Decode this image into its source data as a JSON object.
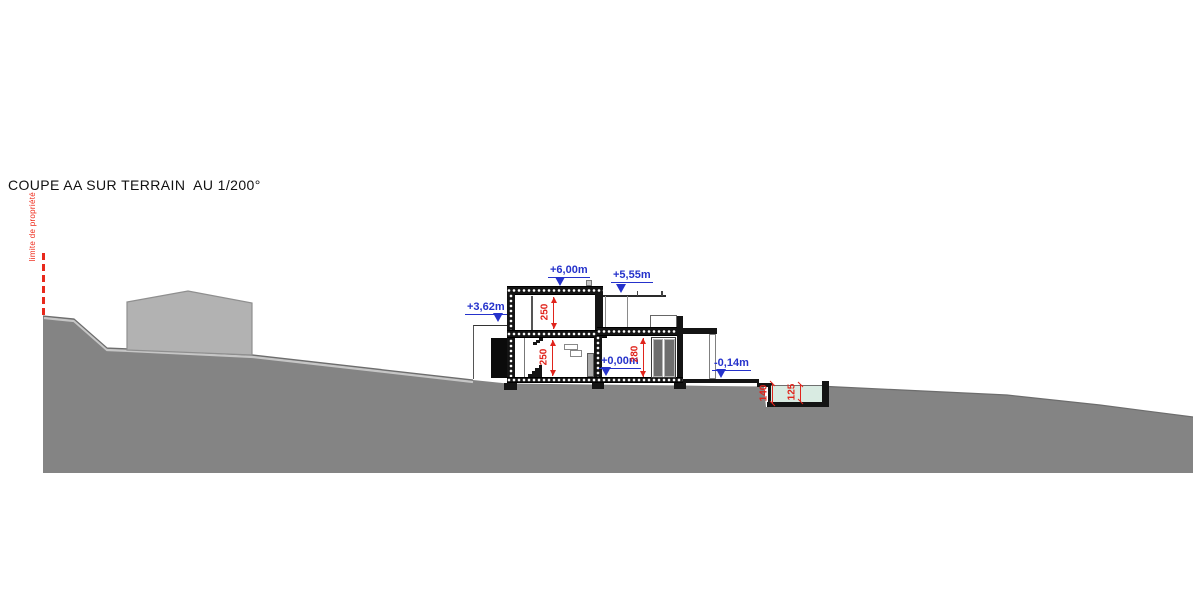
{
  "title": "COUPE AA SUR TERRAIN  AU 1/200°",
  "property_line_label": "limite de propriété",
  "levels": [
    {
      "label": "+6,00m",
      "location": "main flat roof top"
    },
    {
      "label": "+5,55m",
      "location": "canopy over east terrace"
    },
    {
      "label": "+3,62m",
      "location": "entrance porch wall top"
    },
    {
      "label": "+0,00m",
      "location": "ground floor finished level"
    },
    {
      "label": "-0,14m",
      "location": "outdoor terrace level"
    }
  ],
  "dimensions_cm": [
    {
      "label": "250",
      "location": "upper floor clear height"
    },
    {
      "label": "250",
      "location": "ground floor clear height"
    },
    {
      "label": "280",
      "location": "east wing clear height"
    },
    {
      "label": "140",
      "location": "pool structural depth"
    },
    {
      "label": "125",
      "location": "pool water depth"
    }
  ],
  "colors": {
    "level_marker_blue": "#2532cb",
    "dimension_red": "#e0241c",
    "property_line_red": "#e8291c",
    "terrain_gray": "#848484",
    "neighbor_building_gray": "#b2b2b2",
    "pool_water": "#d9ebe2",
    "wall_black": "#141414"
  }
}
